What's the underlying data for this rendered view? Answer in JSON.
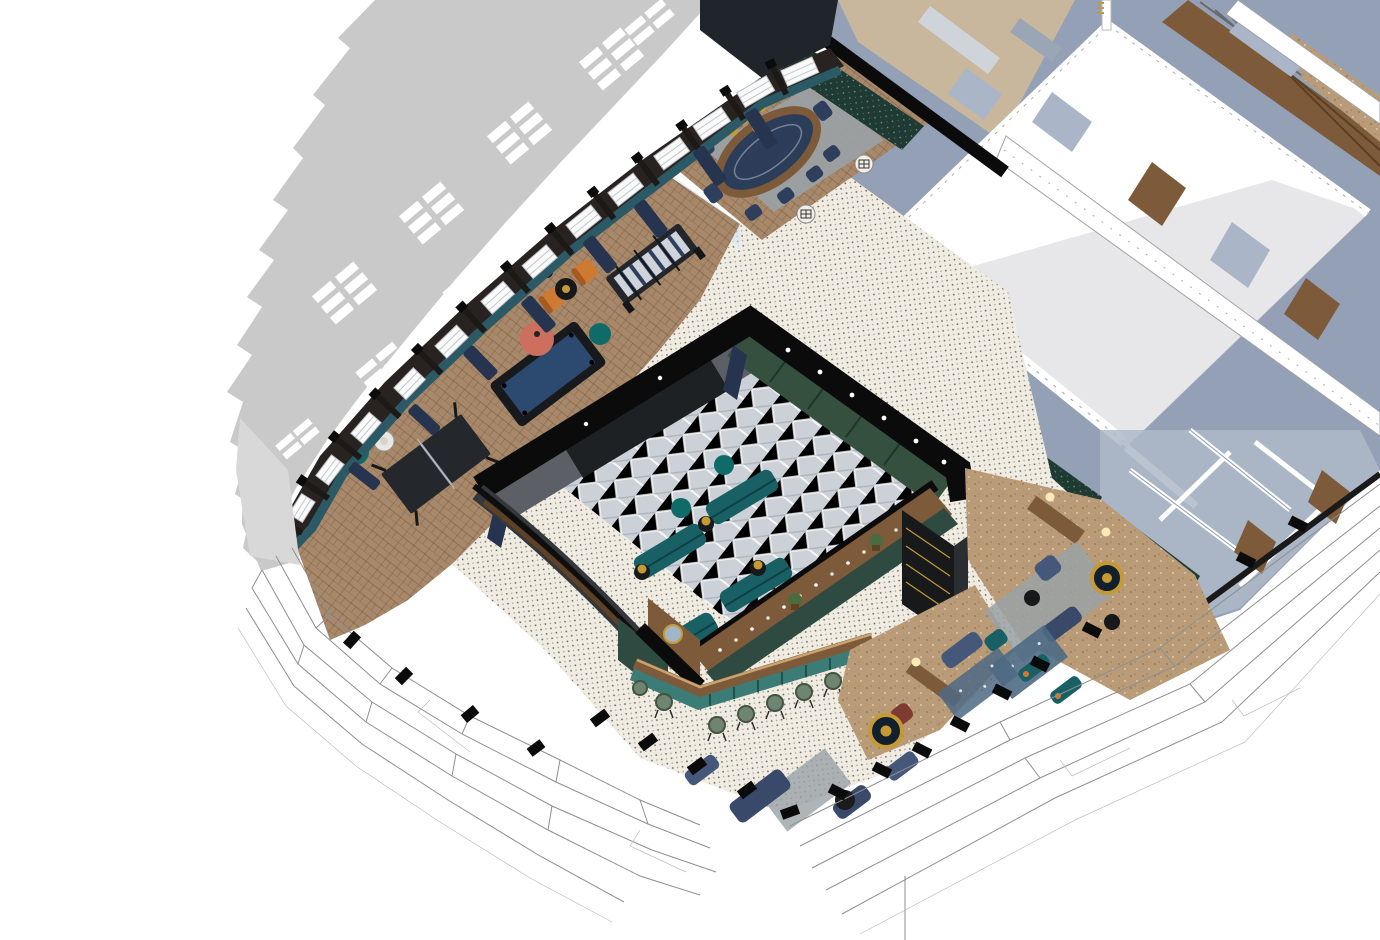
{
  "meta": {
    "description": "Isometric 3D cutaway rendering of an amenity floor: games lounge, poker room, screening room, bar and lounge terraces. No UI chrome or text is visible in the pixels.",
    "render_style": "sketchup-axonometric"
  },
  "palette": {
    "bg": "#ffffff",
    "shadow": "#c9c9c9",
    "ground_shadow": "#d8d8d8",
    "charcoal_wall": "#282320",
    "window_white": "#fafafa",
    "curtain_navy": "#263450",
    "teal_base": "#2b5a66",
    "parquet": "#a8886a",
    "cork": "#b99c77",
    "beige_room": "#c8b79d",
    "mosaic": "#f1ece2",
    "cut_black": "#0b0b0c",
    "theater_green": "#35503f",
    "screen_wall": "#5c6066",
    "screen": "#1e2124",
    "theater_floor": "#ccd1d8",
    "sofa_teal": "#186064",
    "pouf_teal": "#0f6b68",
    "gold": "#c59a35",
    "pool_felt": "#2c4a70",
    "poker_felt": "#2b3d59",
    "wood": "#7d5a39",
    "wood_dark": "#5f4226",
    "bar_teal": "#3c7c77",
    "bar_tile_green": "#2e4a41",
    "stool_green": "#6e8671",
    "lounge_navy": "#46587a",
    "lounge_navy_dark": "#39496a",
    "chair_navy": "#2e3f5e",
    "maroon": "#7e3b32",
    "orange": "#cf7a33",
    "coral": "#cc6f5e",
    "cream": "#e3ddc8",
    "rug_gray": "#9aa2a6",
    "rug_blue": "#4e6a84",
    "blue_wall": "#93a0b5",
    "blue_wall_dark": "#7e8ba1",
    "blue_glass": "#aab6c8",
    "roof_white": "#ffffff",
    "roof_gray": "#e7e7ea",
    "teal_dot_wall": "#1d3a33",
    "glass": "#cfe3ed",
    "linework": "#8f8f8f",
    "linework_light": "#bdbdbd",
    "lamp_glow": "#ffe9b8",
    "plant_green": "#4a6b3e",
    "dark_cabinet": "#17191b"
  },
  "regions": [
    "cast-building-shadow",
    "games-lounge",
    "poker-room",
    "screening-room",
    "bar",
    "lounge-terrace",
    "adjacent-roof-volume",
    "facade-linework-terrace"
  ]
}
